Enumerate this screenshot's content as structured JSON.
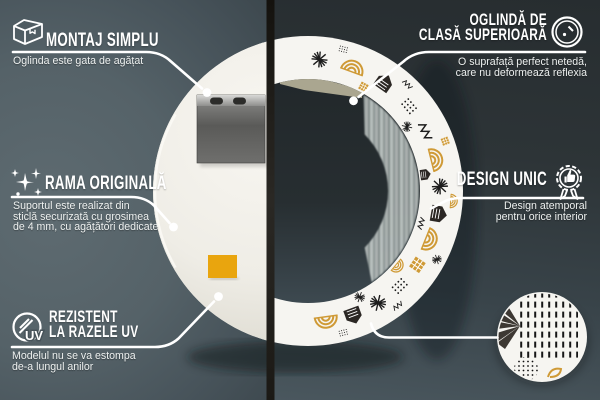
{
  "callouts": {
    "top_left": {
      "icon": "box-icon",
      "title_lines": [
        "MONTAJ SIMPLU"
      ],
      "desc_lines": [
        "Oglinda este gata de agățat"
      ]
    },
    "top_right": {
      "icon": "mirror-icon",
      "title_lines": [
        "OGLINDĂ DE",
        "CLASĂ SUPERIOARĂ"
      ],
      "desc_lines": [
        "O suprafață perfect netedă,",
        "care nu deformează reflexia"
      ]
    },
    "mid_left": {
      "icon": "sparkles-icon",
      "title_lines": [
        "RAMA ORIGINALĂ"
      ],
      "desc_lines": [
        "Suportul este realizat din",
        "sticlă securizată cu grosimea",
        "de 4 mm, cu agățători dedicate"
      ]
    },
    "mid_right": {
      "icon": "award-badge-icon",
      "title_lines": [
        "DESIGN UNIC"
      ],
      "desc_lines": [
        "Design atemporal",
        "pentru orice interior"
      ]
    },
    "bottom_left": {
      "icon": "uv-shield-icon",
      "title_lines": [
        "REZISTENT",
        "LA RAZELE UV"
      ],
      "desc_lines": [
        "Modelul nu se va estompa",
        "de-a lungul anilor"
      ]
    },
    "bottom_right": {
      "icon": "pattern-detail-circle"
    }
  },
  "uv_label": "UV",
  "colors": {
    "callout_line": "#ffffff",
    "accent_gold": "#cf9a36",
    "wall_left": "#55626 8",
    "wall_right": "#2d3437",
    "mirror_back": "#efede6",
    "orange_sticker": "#e9a50e"
  }
}
